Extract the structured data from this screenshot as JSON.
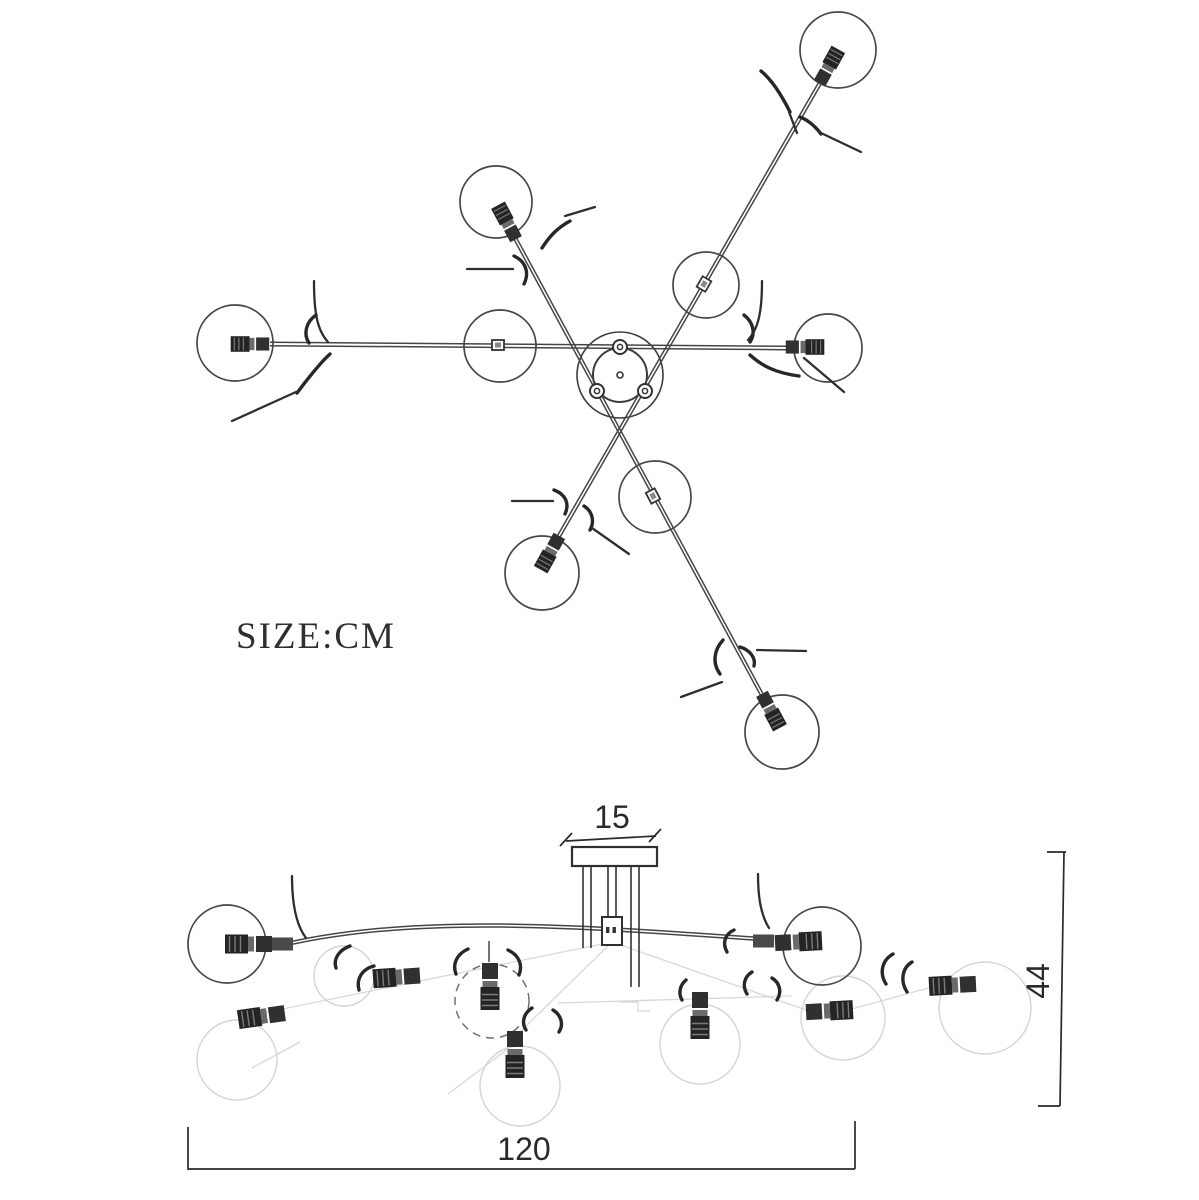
{
  "document": {
    "kind": "technical dimension drawing",
    "subject": "multi-arm ceiling lamp with glass ball shades",
    "views": {
      "top": {
        "name": "top view (plan)",
        "arm_count": 3,
        "sphere_count": 9
      },
      "side": {
        "name": "side view (elevation)"
      }
    }
  },
  "labels": {
    "size_unit": "SIZE:CM"
  },
  "dimensions": {
    "canopy_width_cm": "15",
    "height_cm": "44",
    "width_cm": "120",
    "unit": "cm"
  },
  "colors": {
    "background": "#ffffff",
    "line": "#454545",
    "dark_socket": "#222222",
    "ghost": "#d8d8d8",
    "dimension": "#2a2a2a"
  }
}
